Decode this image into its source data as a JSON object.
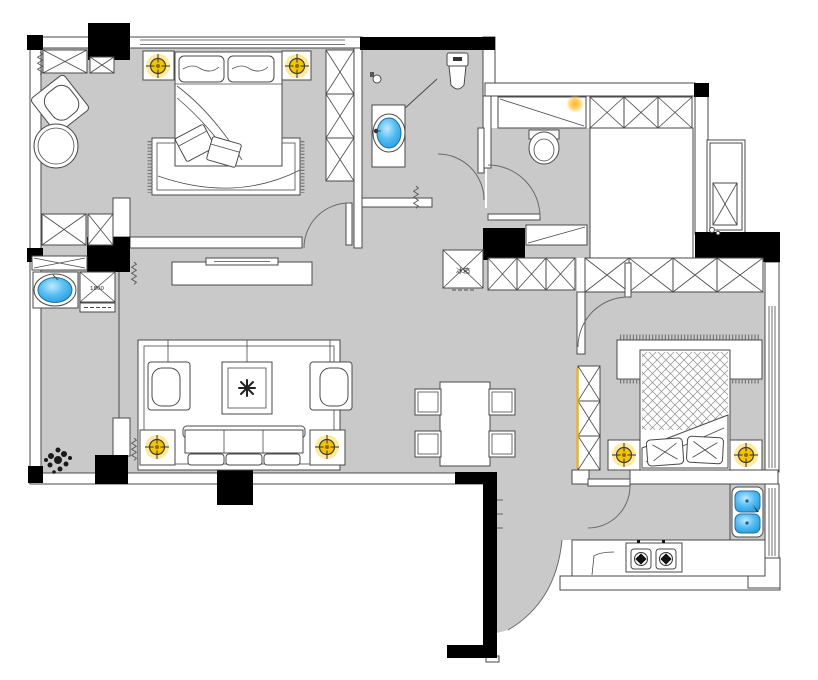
{
  "labels": {
    "fridge": "冰箱",
    "washer": "1800"
  },
  "palette": {
    "floor": "#c9c9c9",
    "wall": "#4a4a4a",
    "column": "#000000",
    "lamp-core": "#f5c400",
    "lamp-glow": "#ffdf66",
    "water": "#3fb3f0",
    "water-light": "#aee4ff",
    "accent": "#e3b341"
  },
  "icons": {
    "ceiling_lamp": "crosshair-circle",
    "spot_light": "glow-dot",
    "wash_basin": "oval-basin",
    "stove_burner": "square-with-diamond",
    "plant": "scribble-cluster",
    "door": "quarter-arc-swing",
    "wardrobe": "x-crossed-box",
    "curtain": "zigzag-spring"
  }
}
